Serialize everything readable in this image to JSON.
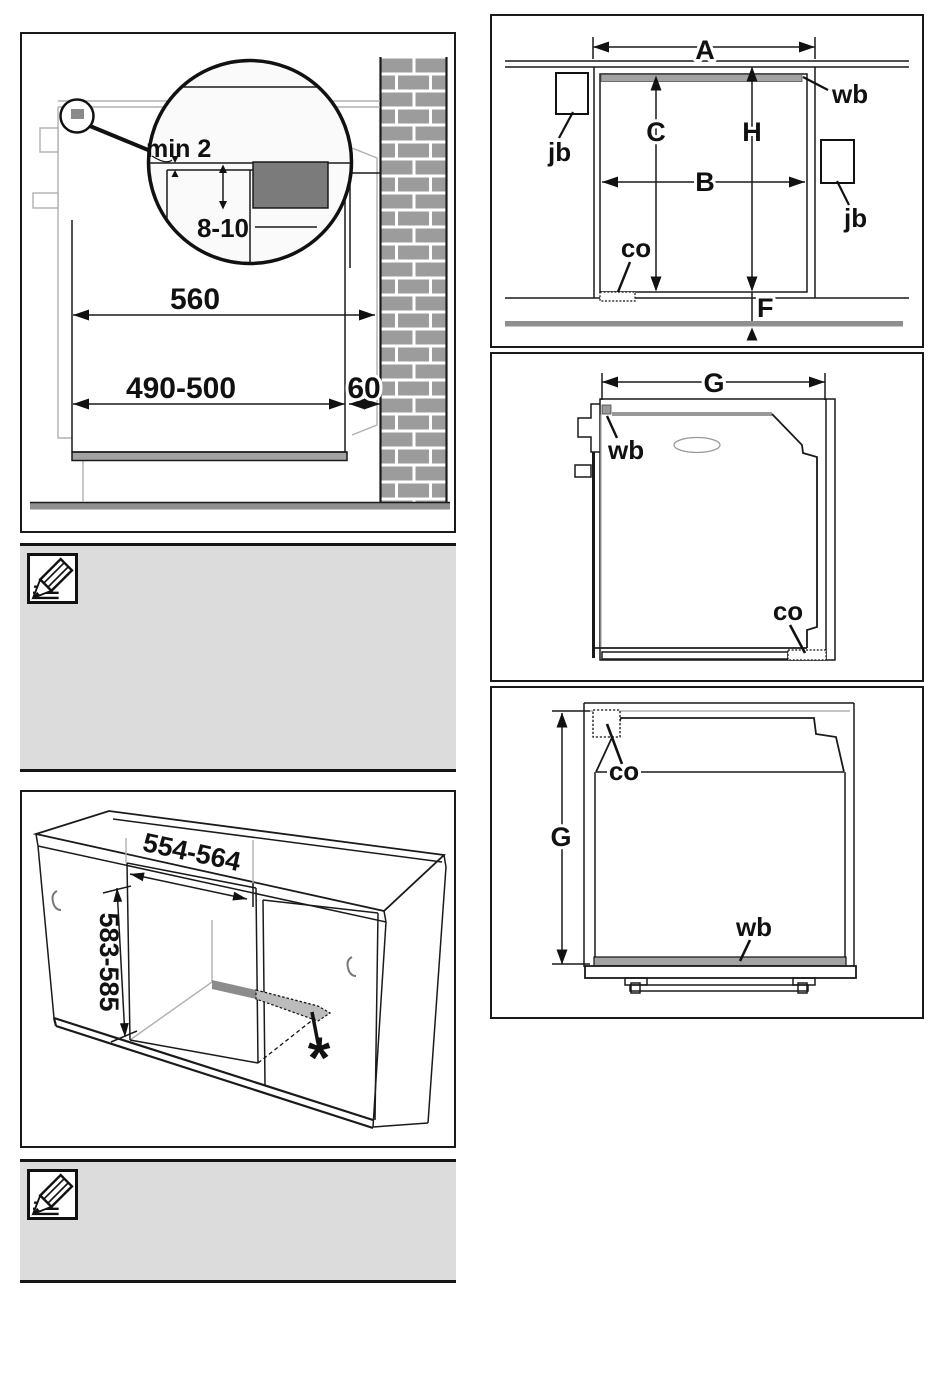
{
  "panels": {
    "side_section": {
      "min_gap": "min 2",
      "overlap_depth": "8-10",
      "niche_depth": "560",
      "cutout_depth": "490-500",
      "wall_clearance": "60"
    },
    "front_view": {
      "width_a": "A",
      "width_b": "B",
      "height_c": "C",
      "height_h": "H",
      "plinth_f": "F",
      "wall_batten": "wb",
      "junction_box_left": "jb",
      "junction_box_right": "jb",
      "cutout": "co"
    },
    "side_view": {
      "depth_g": "G",
      "wall_batten": "wb",
      "cutout": "co"
    },
    "top_view": {
      "depth_g": "G",
      "wall_batten": "wb",
      "cutout": "co"
    },
    "cabinet": {
      "niche_width": "554-564",
      "niche_height": "583-585",
      "footnote_marker": "*"
    }
  },
  "icons": {
    "note_icon": "pencil-note-icon"
  },
  "colors": {
    "brick": "#9c9c9c",
    "worktop_section": "#7b7b7b",
    "batten": "#a3a3a3",
    "floor": "#8f8f8f",
    "strip_dark": "#8c8c8c",
    "strip_light": "#bcbcbc",
    "note_background": "#dcdcdc"
  }
}
